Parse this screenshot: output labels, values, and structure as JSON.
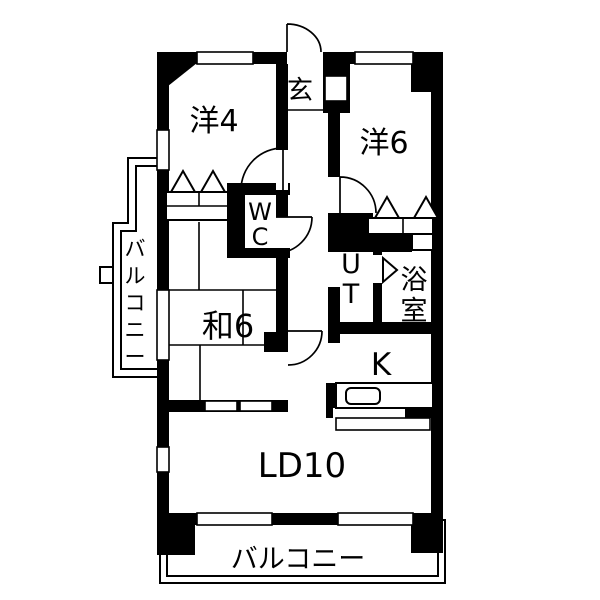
{
  "floorplan": {
    "colors": {
      "wall": "#000000",
      "background": "#ffffff"
    },
    "labels": {
      "entrance": "玄",
      "western_room_4": "洋4",
      "western_room_6": "洋6",
      "toilet_l1": "W",
      "toilet_l2": "C",
      "utility_l1": "U",
      "utility_l2": "T",
      "bathroom_l1": "浴",
      "bathroom_l2": "室",
      "japanese_room_6": "和6",
      "kitchen": "K",
      "living_dining": "LD10",
      "balcony_bottom": "バルコニー",
      "balcony_left_c0": "バ",
      "balcony_left_c1": "ル",
      "balcony_left_c2": "コ",
      "balcony_left_c3": "ニ",
      "balcony_left_c4": "ー"
    }
  }
}
